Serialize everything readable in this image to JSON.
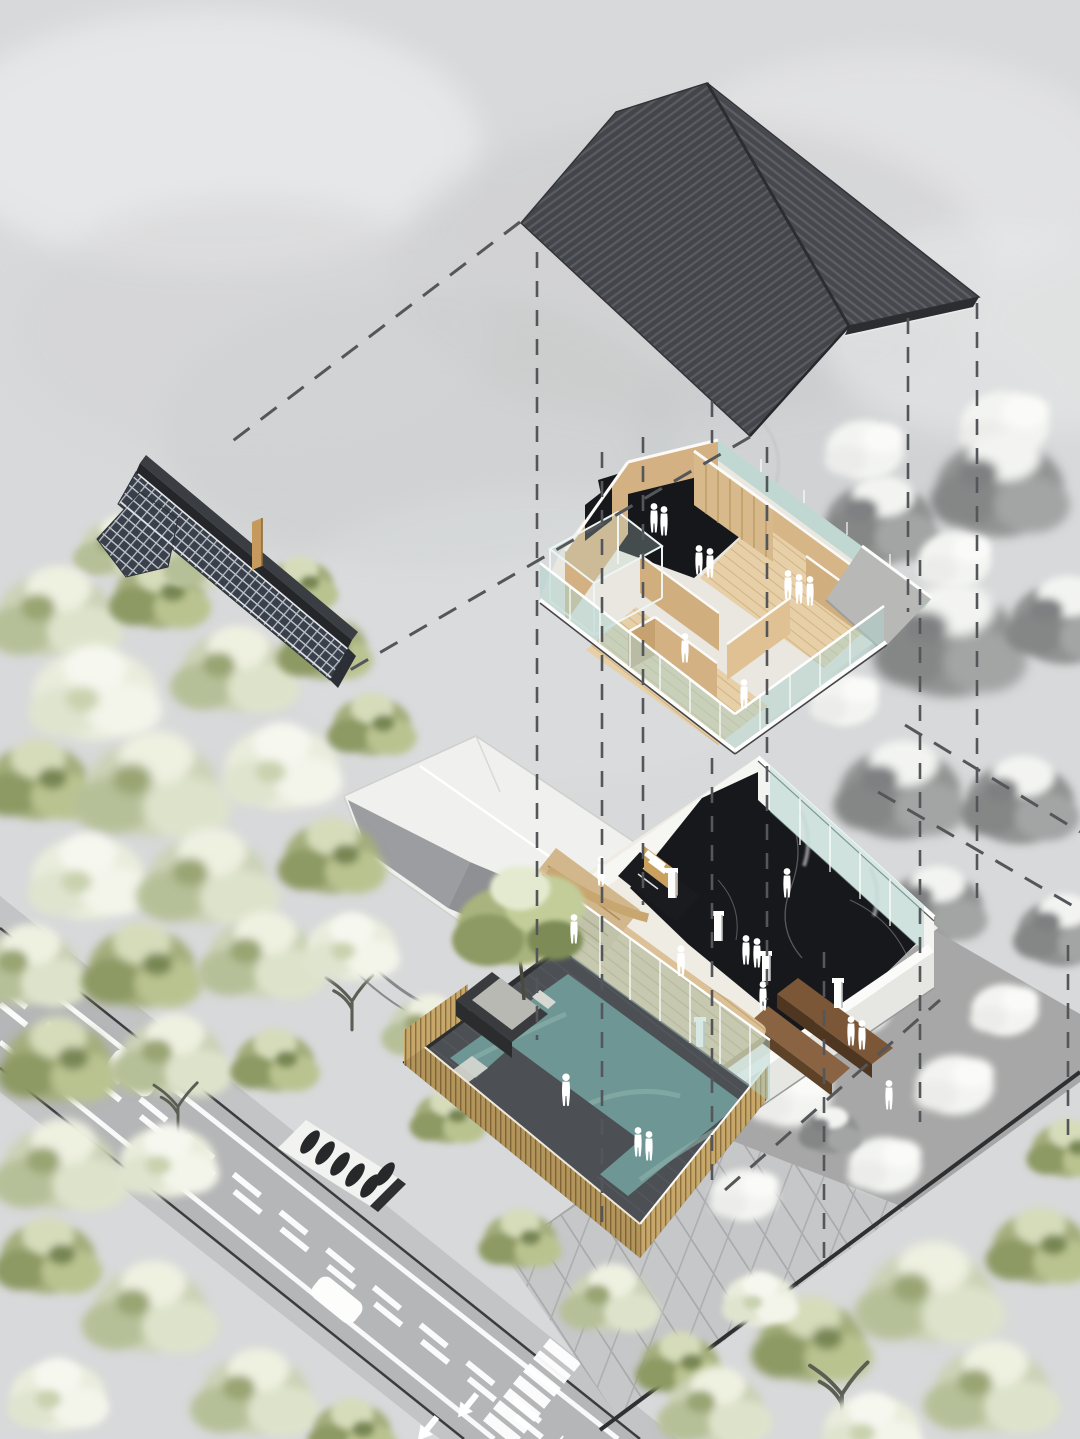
{
  "scene": {
    "kind": "architectural-exploded-axonometric-diagram",
    "visible_text": "none",
    "levels": [
      {
        "id": "pitched-roof",
        "description": "dark striped gable roof, exploded top"
      },
      {
        "id": "tiled-eave-roof",
        "description": "narrow cross-hatched tile wall coping, exploded left"
      },
      {
        "id": "upper-floor",
        "description": "wood partition rooms, black stair void, glass railings"
      },
      {
        "id": "ground-floor",
        "description": "black marble hall, wood deck, benches, stair, glass walls"
      },
      {
        "id": "courtyard",
        "description": "charcoal paving with L-shaped pool, timber slat fence, feature tree"
      }
    ],
    "site_elements": [
      "road-with-center-dashes",
      "zebra-crosswalk",
      "road-arrows",
      "cars",
      "scooter-parking",
      "neighbor-building",
      "pedestrian-plaza",
      "context-gray-zone",
      "watercolor-trees",
      "projection-dashed-lines"
    ],
    "counts": {
      "human_figures_upper_floor": 9,
      "human_figures_ground_floor": 10,
      "human_figures_courtyard": 3,
      "cars": 2,
      "scooters": 6,
      "crosswalk_stripes": 7,
      "road_arrows": 2,
      "dashed_vertical_guides": 11,
      "dashed_diagonal_guides": 5
    }
  },
  "palette": {
    "background": "#d8d9da",
    "cloud_light": "#e7e8e9",
    "cloud_shadow": "#c6c7c9",
    "roof_base": "#43454a",
    "roof_stripe": "#585b60",
    "roof_edge": "#2b2d31",
    "tile_base": "#39404b",
    "tile_line": "#ccd1d6",
    "tile_fascia": "#24262a",
    "wood_wall": "#d3b183",
    "wood_wall_shade": "#c6a271",
    "wood_floor": "#e7cfa7",
    "wood_floor_line": "#d1b486",
    "deck": "#dcc096",
    "deck_line": "#c2a576",
    "void_black": "#16171b",
    "marble_black": "#17181c",
    "glass": "#aed2cb",
    "glass_frame": "#ffffff",
    "wall_white": "#f3f3f1",
    "wall_white_shade": "#e6e6e2",
    "concrete": "#b8b9b7",
    "bench_dark": "#4e3621",
    "bench_mid": "#7b5737",
    "bench_light": "#8a6342",
    "courtyard_paving": "#4c4f54",
    "pool": "#6d9694",
    "pool_light": "#8fb3ae",
    "fence": "#c7a76a",
    "fence_line": "#8a7040",
    "fence_shade": "#b3955c",
    "road": "#b5b6b7",
    "sidewalk": "#c3c4c5",
    "curb": "#3b3c3d",
    "marking": "#ffffff",
    "plaza": "#c6c7c8",
    "plaza_line": "#a7a8aa",
    "gray_zone": "#a6a7a6",
    "boundary": "#2f3032",
    "tree_sage": "#cbd2b6",
    "tree_olive": "#a3ad7c",
    "tree_cream": "#e9ecdb",
    "tree_gray": "#919292",
    "tree_white": "#f3f4f1",
    "neighbor_white": "#f0f0ee",
    "neighbor_gray": "#9c9da0",
    "dash": "#55565a",
    "figure": "#ffffff"
  }
}
